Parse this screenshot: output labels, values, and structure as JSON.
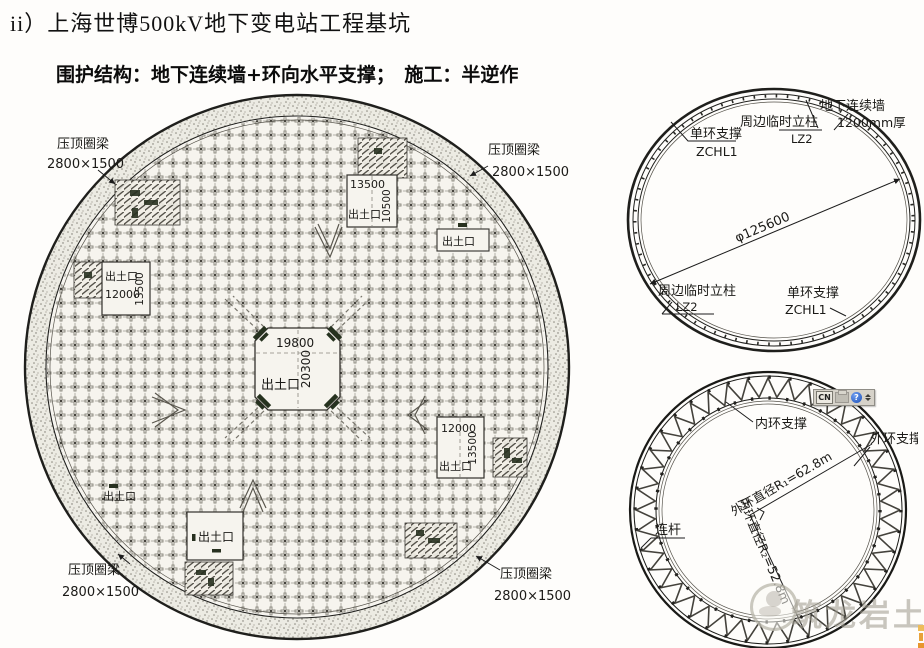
{
  "slide": {
    "title": "ii）上海世博500kV地下变电站工程基坑",
    "subtitle": "围护结构：地下连续墙+环向水平支撑；　施工：半逆作"
  },
  "main_plan": {
    "ring_beam_label": "压顶圈梁",
    "ring_beam_size": "2800×1500",
    "openings": {
      "top": {
        "label": "出土口",
        "width": "13500",
        "height": "10500"
      },
      "top_small": {
        "label": "出土口"
      },
      "left": {
        "label": "出土口",
        "width": "12000",
        "height": "13500"
      },
      "center": {
        "label": "出土口",
        "width": "19800",
        "height": "20300"
      },
      "right": {
        "label": "出土口",
        "width": "12000",
        "height": "13500"
      },
      "bottom": {
        "label": "出土口"
      },
      "bottom_small": {
        "label": "出土口"
      }
    }
  },
  "single_ring_plan": {
    "support_label": "单环支撑",
    "support_code": "ZCHL1",
    "column_label": "周边临时立柱",
    "column_code": "LZ2",
    "wall_label": "地下连续墙",
    "wall_thickness": "1200mm厚",
    "diameter": "φ125600"
  },
  "double_ring_plan": {
    "inner_support": "内环支撑",
    "outer_support": "外环支撑",
    "tie_rod": "连杆",
    "outer_diameter": "外环直径R₁=62.8m",
    "inner_diameter": "内环直径R₂=52.8m"
  },
  "language_bar": {
    "layout": "CN"
  },
  "watermark": {
    "text": "筑龙岩土"
  },
  "colors": {
    "ink": "#1c1c1c",
    "paper": "#f6f4ee",
    "watermark": "#a09c90",
    "edge_accent": "#edaa42"
  }
}
